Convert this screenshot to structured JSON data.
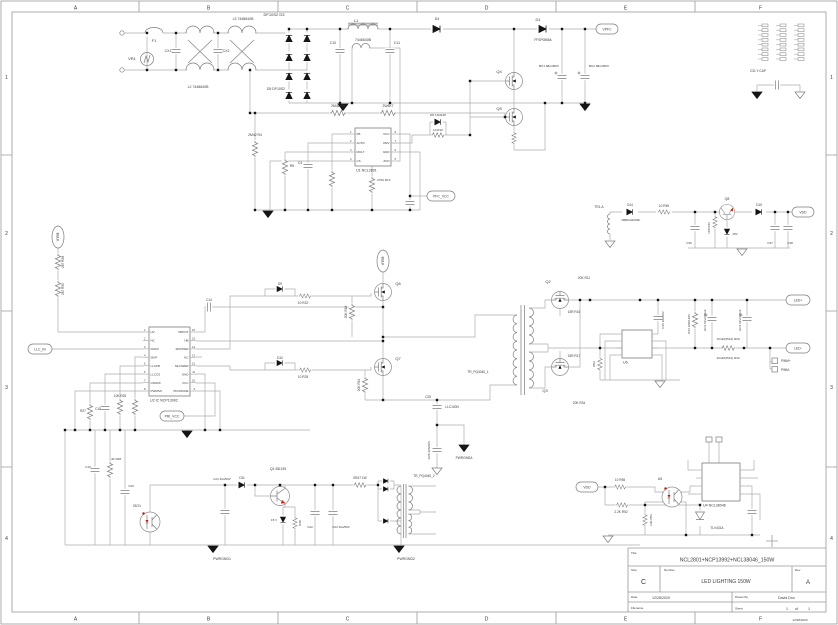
{
  "colors": {
    "wire": "#aaaeaa",
    "symbol": "#7c7c7c",
    "black": "#151515",
    "text": "#3a3a3a",
    "red": "#c21807",
    "frame": "#9a9a9a",
    "muted": "#999999"
  },
  "frame": {
    "cols": [
      "A",
      "B",
      "C",
      "D",
      "E",
      "F"
    ],
    "rows": [
      "1",
      "2",
      "3",
      "4"
    ]
  },
  "title_block": {
    "title_label": "Title",
    "title": "NCL2801+NCP13992+NCL38046_150W",
    "size_label": "Size",
    "size": "C",
    "number_label": "Number",
    "number": "LED LIGHTING 150W",
    "rev_label": "Rev",
    "rev": "A",
    "date_label": "Date",
    "date": "12/28/2020",
    "drawn_label": "Drawn By",
    "drawn": "David Dou",
    "file_label": "Filename",
    "sheet_label": "Sheet",
    "sheet": "1",
    "of": "of",
    "total": "1",
    "print_stamp": "12/28/2020"
  },
  "schematic": {
    "labels": [
      {
        "t": "F1",
        "x": 154,
        "y": 42
      },
      {
        "t": "VR1",
        "x": 132,
        "y": 60
      },
      {
        "t": "CX1",
        "x": 168,
        "y": 52,
        "s": 3.5
      },
      {
        "t": "CX2",
        "x": 226,
        "y": 52,
        "s": 3.5
      },
      {
        "t": "L2 7448640B",
        "x": 198,
        "y": 88,
        "s": 3.5
      },
      {
        "t": "L3 7448640B",
        "x": 243,
        "y": 20,
        "s": 3.5
      },
      {
        "t": "DF10S2 D3",
        "x": 274,
        "y": 16
      },
      {
        "t": "D5 DF10S2",
        "x": 276,
        "y": 90,
        "s": 3.5
      },
      {
        "t": "L1",
        "x": 356,
        "y": 22
      },
      {
        "t": "7446640B",
        "x": 363,
        "y": 41,
        "s": 3.5
      },
      {
        "t": "C10",
        "x": 333,
        "y": 44,
        "s": 3.5
      },
      {
        "t": "C11",
        "x": 397,
        "y": 44,
        "s": 3.5
      },
      {
        "t": "D4",
        "x": 437,
        "y": 20,
        "s": 3.5
      },
      {
        "t": "D1",
        "x": 538,
        "y": 21
      },
      {
        "t": "FFSP0865A",
        "x": 543,
        "y": 41,
        "s": 3.2
      },
      {
        "t": "Q4",
        "x": 499,
        "y": 73
      },
      {
        "t": "Q5",
        "x": 499,
        "y": 110
      },
      {
        "t": "BC1 68u/450V",
        "x": 549,
        "y": 67,
        "s": 3.1
      },
      {
        "t": "BC2 68u/450V",
        "x": 599,
        "y": 67,
        "s": 3.1
      },
      {
        "t": "2M42 R6",
        "x": 338,
        "y": 107,
        "s": 3.4
      },
      {
        "t": "2W4K7",
        "x": 388,
        "y": 107,
        "s": 3.4
      },
      {
        "t": "2M42 R4",
        "x": 255,
        "y": 136,
        "s": 3.4
      },
      {
        "t": "R5",
        "x": 292,
        "y": 167,
        "s": 3.4
      },
      {
        "t": "C4",
        "x": 300,
        "y": 164,
        "s": 3.4
      },
      {
        "t": "D6 1N4148",
        "x": 438,
        "y": 116,
        "s": 3.1
      },
      {
        "t": "10 R10",
        "x": 438,
        "y": 131,
        "s": 3.1
      },
      {
        "t": "2700 R13",
        "x": 377,
        "y": 181,
        "s": 3.1,
        "a": "start"
      },
      {
        "t": "10K R26",
        "x": 120,
        "y": 397,
        "s": 3.2
      },
      {
        "t": "C15",
        "x": 98,
        "y": 410,
        "s": 3.2
      },
      {
        "t": "R27",
        "x": 83,
        "y": 412,
        "s": 3.2
      },
      {
        "t": "C14",
        "x": 209,
        "y": 301,
        "s": 3.2
      },
      {
        "t": "D9",
        "x": 280,
        "y": 285,
        "s": 3.2
      },
      {
        "t": "10 R22",
        "x": 303,
        "y": 304,
        "s": 3.2
      },
      {
        "t": "20K R18",
        "x": 347,
        "y": 312,
        "r": -90,
        "s": 3.2
      },
      {
        "t": "Q6",
        "x": 398,
        "y": 285
      },
      {
        "t": "D10",
        "x": 280,
        "y": 359,
        "s": 3.2
      },
      {
        "t": "10 R25",
        "x": 303,
        "y": 378,
        "s": 3.2
      },
      {
        "t": "Q7",
        "x": 398,
        "y": 360
      },
      {
        "t": "20K R24",
        "x": 360,
        "y": 385,
        "r": -90,
        "s": 3.2
      },
      {
        "t": "C25",
        "x": 428,
        "y": 398,
        "s": 3.2
      },
      {
        "t": "LLC100N",
        "x": 452,
        "y": 408,
        "s": 3.2
      },
      {
        "t": "C26 223/2KV",
        "x": 430,
        "y": 450,
        "r": -90,
        "s": 3.1
      },
      {
        "t": "PWRGNDA",
        "x": 464,
        "y": 459,
        "s": 3.2
      },
      {
        "t": "TR_PQ4040_1",
        "x": 478,
        "y": 373,
        "s": 3.2
      },
      {
        "t": "Q2",
        "x": 548,
        "y": 283
      },
      {
        "t": "20K R11",
        "x": 584,
        "y": 279,
        "s": 3.2
      },
      {
        "t": "15R R16",
        "x": 574,
        "y": 313,
        "s": 3.2
      },
      {
        "t": "Q3",
        "x": 545,
        "y": 392
      },
      {
        "t": "15R R17",
        "x": 574,
        "y": 357,
        "s": 3.2
      },
      {
        "t": "20K R34",
        "x": 579,
        "y": 404,
        "s": 3.2
      },
      {
        "t": "10mR(2512) R29",
        "x": 728,
        "y": 340,
        "s": 3
      },
      {
        "t": "10mR(2512) R30",
        "x": 728,
        "y": 359,
        "s": 3
      },
      {
        "t": "R44 10R/1206",
        "x": 690,
        "y": 324,
        "r": -90,
        "s": 3
      },
      {
        "t": "EC3 63V/470uF",
        "x": 706,
        "y": 320,
        "r": -90,
        "s": 3
      },
      {
        "t": "EC4 63V/470uF",
        "x": 741,
        "y": 320,
        "r": -90,
        "s": 3
      },
      {
        "t": "PWM+",
        "x": 781,
        "y": 362,
        "s": 3.2,
        "a": "start"
      },
      {
        "t": "PWM-",
        "x": 781,
        "y": 371,
        "s": 3.2,
        "a": "start"
      },
      {
        "t": "C35 104/50V",
        "x": 664,
        "y": 320,
        "r": -90,
        "s": 3
      },
      {
        "t": "R52",
        "x": 595,
        "y": 364,
        "r": -90,
        "s": 3
      },
      {
        "t": "TR1-A",
        "x": 599,
        "y": 208,
        "s": 3.2
      },
      {
        "t": "D14",
        "x": 630,
        "y": 206,
        "s": 3.2
      },
      {
        "t": "MBR2H100SF",
        "x": 631,
        "y": 221,
        "s": 2.9
      },
      {
        "t": "10 R45",
        "x": 664,
        "y": 207,
        "s": 3.2
      },
      {
        "t": "C36",
        "x": 689,
        "y": 244,
        "s": 3
      },
      {
        "t": "1K8 R43",
        "x": 710,
        "y": 228,
        "r": -90,
        "s": 3
      },
      {
        "t": "Q8",
        "x": 727,
        "y": 200,
        "s": 3.5
      },
      {
        "t": "15V",
        "x": 735,
        "y": 235,
        "s": 3
      },
      {
        "t": "D15",
        "x": 759,
        "y": 206,
        "s": 3.2
      },
      {
        "t": "C37",
        "x": 770,
        "y": 244,
        "s": 3
      },
      {
        "t": "C38",
        "x": 790,
        "y": 244,
        "s": 3
      },
      {
        "t": "C31 Y-CAP",
        "x": 758,
        "y": 72,
        "s": 3.2
      },
      {
        "t": "C24 10u/50V",
        "x": 222,
        "y": 480,
        "s": 3
      },
      {
        "t": "D11",
        "x": 242,
        "y": 479,
        "s": 3.2
      },
      {
        "t": "Q1 BD139",
        "x": 278,
        "y": 470,
        "s": 3.5
      },
      {
        "t": "15 V",
        "x": 274,
        "y": 521,
        "s": 3
      },
      {
        "t": "R48",
        "x": 301,
        "y": 523,
        "r": -90,
        "s": 3
      },
      {
        "t": "C22",
        "x": 310,
        "y": 528,
        "s": 3
      },
      {
        "t": "C23 10u/50V",
        "x": 341,
        "y": 528,
        "s": 3
      },
      {
        "t": "0R47 1W",
        "x": 360,
        "y": 479,
        "s": 3.2
      },
      {
        "t": "TR_PQ4040_2",
        "x": 424,
        "y": 477,
        "s": 3.2
      },
      {
        "t": "PWRGND1",
        "x": 222,
        "y": 560,
        "s": 3.5
      },
      {
        "t": "PWRGND2",
        "x": 406,
        "y": 560,
        "s": 3.5
      },
      {
        "t": "ISO1",
        "x": 137,
        "y": 507,
        "s": 3.5
      },
      {
        "t": "C19",
        "x": 88,
        "y": 468,
        "s": 3
      },
      {
        "t": "4K R28",
        "x": 116,
        "y": 460,
        "s": 3
      },
      {
        "t": "C20",
        "x": 131,
        "y": 487,
        "s": 3
      },
      {
        "t": "10 R55",
        "x": 620,
        "y": 481,
        "s": 3.2
      },
      {
        "t": "2.2K R52",
        "x": 621,
        "y": 513,
        "s": 3.2
      },
      {
        "t": "U5",
        "x": 660,
        "y": 480,
        "s": 3.5
      },
      {
        "t": "13K R53",
        "x": 652,
        "y": 520,
        "r": -90,
        "s": 3
      },
      {
        "t": "TLV431A",
        "x": 717,
        "y": 529,
        "s": 3.2
      },
      {
        "t": "267 R58",
        "x": 64,
        "y": 262,
        "r": -90,
        "s": 3.2
      },
      {
        "t": "267 R59",
        "x": 64,
        "y": 289,
        "r": -90,
        "s": 3.2
      },
      {
        "t": "12/28/2020",
        "x": 800,
        "y": 621,
        "s": 3,
        "m": 1
      }
    ],
    "ovals": [
      {
        "t": "VPFC",
        "x": 596,
        "y": 24,
        "w": 22,
        "h": 10
      },
      {
        "t": "PFC_VCC",
        "x": 427,
        "y": 191,
        "w": 28,
        "h": 10
      },
      {
        "t": "BULK",
        "x": 52,
        "y": 226,
        "w": 12,
        "h": 22,
        "r": 90
      },
      {
        "t": "BULK",
        "x": 377,
        "y": 250,
        "w": 12,
        "h": 22,
        "r": 90
      },
      {
        "t": "LLC_IN",
        "x": 28,
        "y": 344,
        "w": 24,
        "h": 10
      },
      {
        "t": "PRI_VCC",
        "x": 160,
        "y": 411,
        "w": 24,
        "h": 10
      },
      {
        "t": "LED+",
        "x": 786,
        "y": 295,
        "w": 24,
        "h": 10
      },
      {
        "t": "LED-",
        "x": 786,
        "y": 343,
        "w": 24,
        "h": 10
      },
      {
        "t": "VDD",
        "x": 792,
        "y": 207,
        "w": 22,
        "h": 10
      },
      {
        "t": "VDD",
        "x": 576,
        "y": 482,
        "w": 22,
        "h": 10
      }
    ],
    "ics": [
      {
        "label": "U1 NCL2801",
        "x": 355,
        "y": 128,
        "w": 36,
        "h": 38,
        "pad": 6,
        "pitch": 9,
        "left": [
          "FB",
          "ACTR",
          "MULT",
          "CS"
        ],
        "right": [
          "VCC",
          "DRV",
          "GND",
          "ZCD"
        ],
        "lnum": [
          "1",
          "2",
          "3",
          "4"
        ],
        "rnum": [
          "8",
          "7",
          "6",
          "5"
        ]
      },
      {
        "label": "U2 IC NCP13992",
        "x": 149,
        "y": 327,
        "w": 41,
        "h": 69,
        "pad": 5,
        "pitch": 8.43,
        "left": [
          "HV",
          "NC",
          "FMAX",
          "SKIP",
          "LLCFB",
          "LLCCS",
          "ONOFF",
          "PWMSS"
        ],
        "right": [
          "VBOOT",
          "HB",
          "MUPPER",
          "NC",
          "MLOWER",
          "GND",
          "VCC",
          "PFCMODE"
        ],
        "lnum": [
          "1",
          "2",
          "3",
          "4",
          "5",
          "6",
          "7",
          "8"
        ],
        "rnum": [
          "16",
          "15",
          "14",
          "13",
          "12",
          "11",
          "10",
          "9"
        ]
      },
      {
        "label": "U6",
        "x": 622,
        "y": 330,
        "w": 30,
        "h": 28,
        "pad": 4,
        "pitch": 7,
        "left": [
          "",
          "",
          "",
          ""
        ],
        "right": [
          "",
          "",
          "",
          ""
        ],
        "lnum": [],
        "rnum": []
      },
      {
        "label": "U4 NCL38046",
        "x": 702,
        "y": 463,
        "w": 38,
        "h": 38,
        "pad": 7,
        "pitch": 8,
        "left": [
          "",
          "",
          "",
          ""
        ],
        "right": [
          "",
          "",
          "",
          ""
        ],
        "lnum": [],
        "rnum": []
      }
    ],
    "grounds": [
      {
        "x": 343,
        "y": 104
      },
      {
        "x": 585,
        "y": 104
      },
      {
        "x": 268,
        "y": 211
      },
      {
        "x": 187,
        "y": 431
      },
      {
        "x": 464,
        "y": 445
      },
      {
        "x": 213,
        "y": 546
      },
      {
        "x": 399,
        "y": 546
      },
      {
        "x": 757,
        "y": 92
      },
      {
        "x": 800,
        "y": 92,
        "open": 1
      },
      {
        "x": 610,
        "y": 241,
        "open": 1
      },
      {
        "x": 742,
        "y": 249,
        "open": 1
      },
      {
        "x": 660,
        "y": 381,
        "open": 1
      },
      {
        "x": 608,
        "y": 536,
        "open": 1
      },
      {
        "x": 437,
        "y": 468,
        "open": 1
      }
    ]
  }
}
